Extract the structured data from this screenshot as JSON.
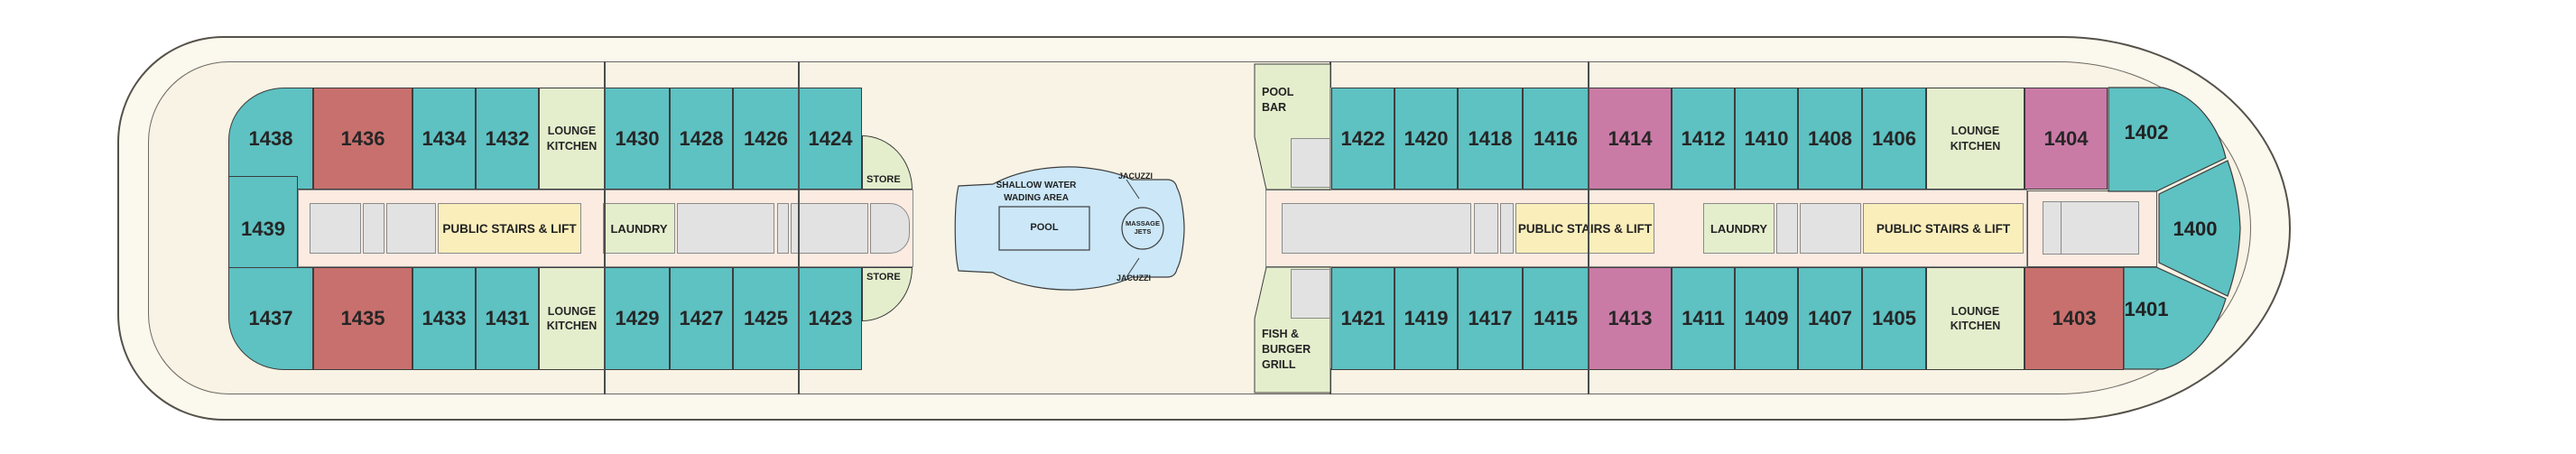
{
  "colors": {
    "teal": "#5ec1c2",
    "red": "#c8706d",
    "pink": "#c97ba6",
    "green": "#e4eecd",
    "yellow": "#faeebb",
    "gray": "#e2e2e2",
    "corridor": "#fcebe1",
    "deck": "#f8f3e4",
    "hull": "#fbf8ee",
    "pool": "#cbe7f8",
    "outline": "#4c4c4c"
  },
  "aft": {
    "cabins_top": [
      "1438",
      "1436",
      "1434",
      "1432"
    ],
    "cabins_top_fwd": [
      "1430",
      "1428",
      "1426",
      "1424"
    ],
    "cabin_mid": "1439",
    "cabins_bottom": [
      "1437",
      "1435",
      "1433",
      "1431"
    ],
    "cabins_bottom_fwd": [
      "1429",
      "1427",
      "1425",
      "1423"
    ],
    "lounge_kitchen_top": "LOUNGE KITCHEN",
    "lounge_kitchen_bottom": "LOUNGE KITCHEN",
    "stairs": "PUBLIC STAIRS & LIFT",
    "laundry": "LAUNDRY",
    "store_top": "STORE",
    "store_bottom": "STORE"
  },
  "midship": {
    "shallow_water_line1": "SHALLOW WATER",
    "shallow_water_line2": "WADING AREA",
    "pool": "POOL",
    "massage_jets": "MASSAGE JETS",
    "jacuzzi_top": "JACUZZI",
    "jacuzzi_bottom": "JACUZZI",
    "pool_bar": "POOL BAR",
    "fish_burger_grill": "FISH & BURGER GRILL"
  },
  "forward": {
    "cabins_top": [
      "1422",
      "1420",
      "1418",
      "1416",
      "1414",
      "1412",
      "1410",
      "1408",
      "1406"
    ],
    "cabins_bottom": [
      "1421",
      "1419",
      "1417",
      "1415",
      "1413",
      "1411",
      "1409",
      "1407",
      "1405"
    ],
    "lounge_kitchen_top": "LOUNGE KITCHEN",
    "lounge_kitchen_bottom": "LOUNGE KITCHEN",
    "stairs_aft": "PUBLIC STAIRS & LIFT",
    "stairs_fwd": "PUBLIC STAIRS & LIFT",
    "laundry": "LAUNDRY",
    "cabin_1404": "1404",
    "cabin_1402": "1402",
    "cabin_1400": "1400",
    "cabin_1403": "1403",
    "cabin_1401": "1401"
  }
}
